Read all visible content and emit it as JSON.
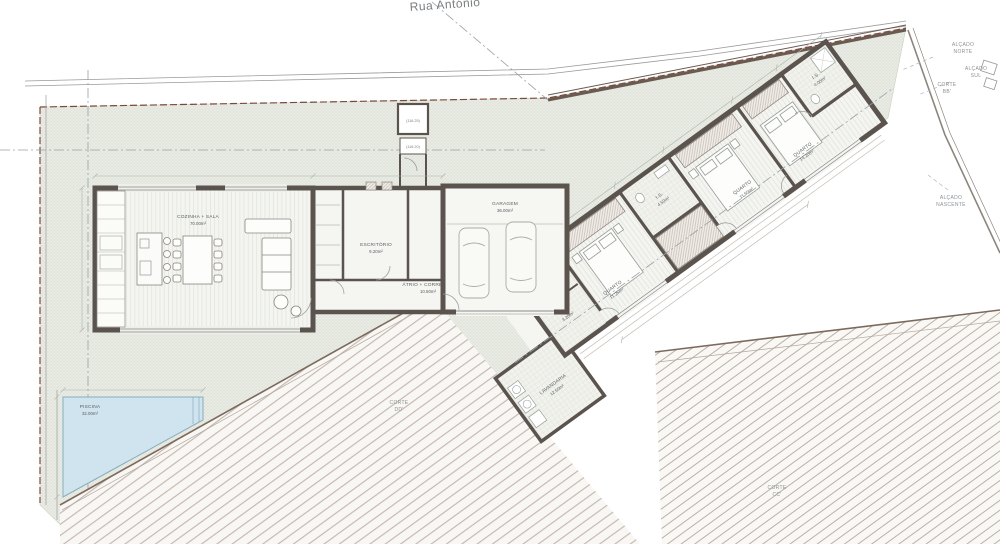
{
  "street": {
    "label": "Rua António"
  },
  "rooms": {
    "living": {
      "name": "COZINHA + SALA",
      "area": "70.00m²"
    },
    "office": {
      "name": "ESCRITÓRIO",
      "area": "9.20m²"
    },
    "hall": {
      "name": "ÁTRIO + CORREDOR",
      "area": "10.50m²"
    },
    "garage": {
      "name": "GARAGEM",
      "area": "36.00m²"
    },
    "laundry": {
      "name": "LAVANDARIA",
      "area": "12.50m²"
    },
    "bath_hall": {
      "name": "I.S.",
      "area": "3.20m²"
    },
    "bedroom1": {
      "name": "QUARTO",
      "area": "11.25m²"
    },
    "bath1": {
      "name": "I.S.",
      "area": "4.50m²"
    },
    "bedroom2": {
      "name": "QUARTO",
      "area": "11.50m²"
    },
    "bedroom3": {
      "name": "QUARTO",
      "area": "14.20m²"
    },
    "bath2": {
      "name": "I.S.",
      "area": "4.00m²"
    },
    "pool": {
      "name": "PISCINA",
      "area": "32.00m²"
    }
  },
  "annotations": {
    "alcado_norte": {
      "l1": "ALÇADO",
      "l2": "NORTE"
    },
    "alcado_sul": {
      "l1": "ALÇADO",
      "l2": "SUL"
    },
    "corte_bb": {
      "l1": "CORTE",
      "l2": "BB'"
    },
    "alcado_nascente": {
      "l1": "ALÇADO",
      "l2": "NASCENTE"
    },
    "corte_dd": {
      "l1": "CORTE",
      "l2": "DD'"
    },
    "corte_cc": {
      "l1": "CORTE",
      "l2": "CC'"
    }
  },
  "levels": {
    "entry_upper": "(116.25)",
    "entry_lower": "(116.20)"
  },
  "colors": {
    "wall": "#5b544e",
    "water": "#cfe4ee",
    "garden_hatch": "#ccd2c6",
    "boundary": "#7b4a3c",
    "deck_hatch": "#c2b5ab"
  }
}
